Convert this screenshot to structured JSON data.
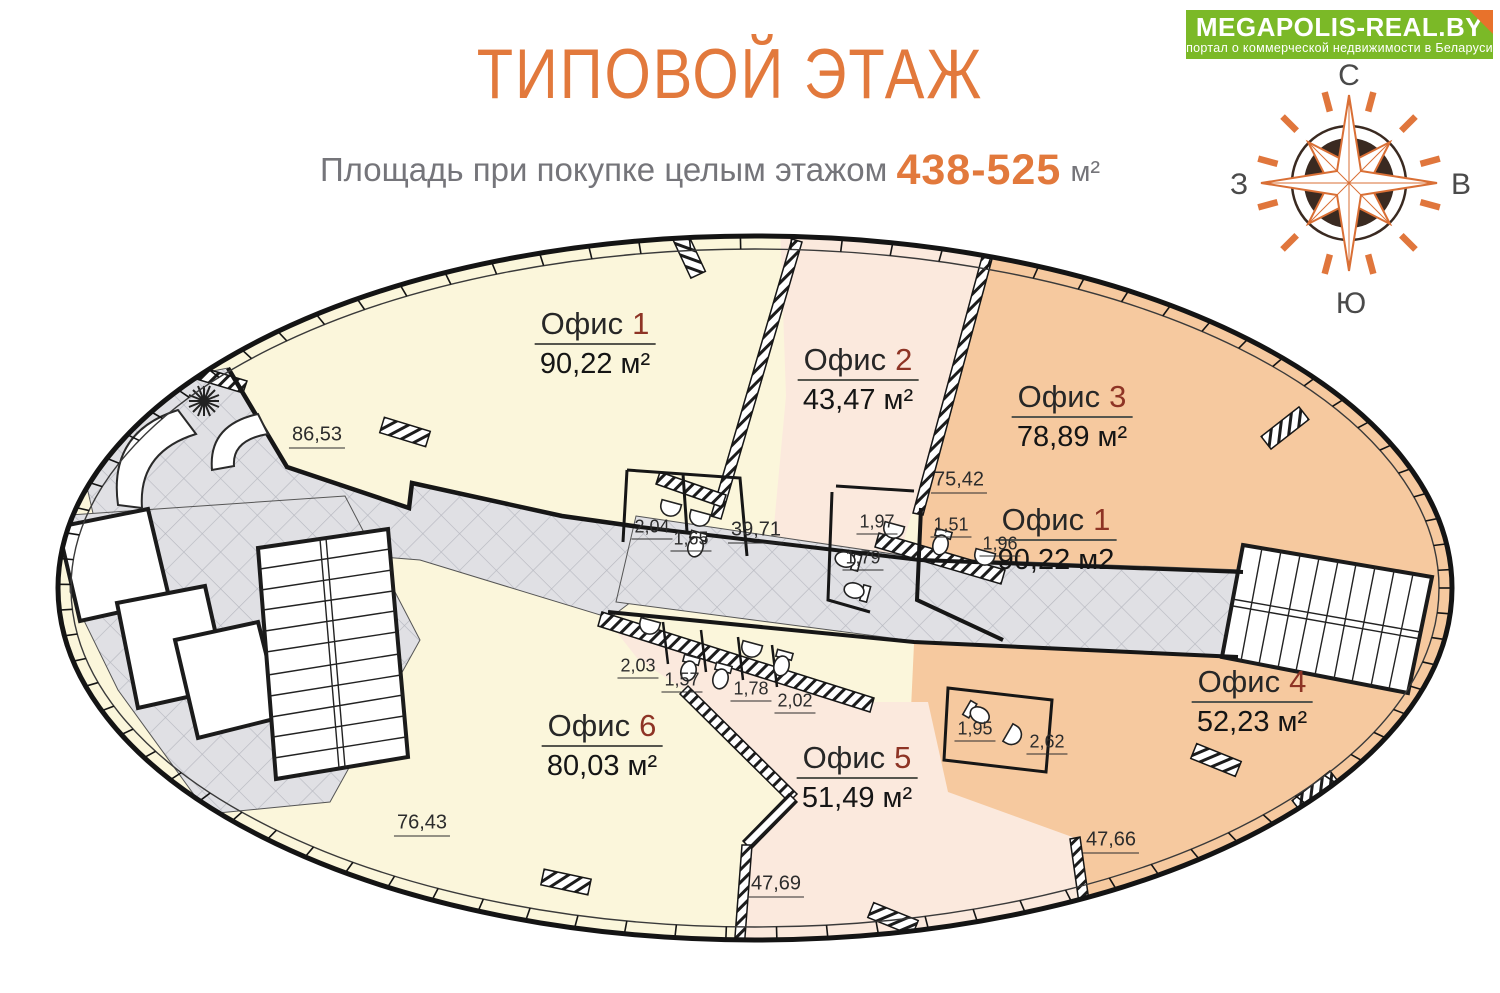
{
  "logo": {
    "title": "MEGAPOLIS-REAL.BY",
    "subtitle": "портал о коммерческой недвижимости в Беларуси"
  },
  "header": {
    "title": "ТИПОВОЙ ЭТАЖ",
    "subtitle_prefix": "Площадь при покупке целым этажом",
    "area_range": "438-525",
    "area_unit": "м²"
  },
  "compass": {
    "north": "С",
    "east": "В",
    "south": "Ю",
    "west": "З"
  },
  "plan": {
    "offices": [
      {
        "id": "office-1",
        "label": "Офис",
        "number": "1",
        "area": "90,22 м²"
      },
      {
        "id": "office-2",
        "label": "Офис",
        "number": "2",
        "area": "43,47 м²"
      },
      {
        "id": "office-3",
        "label": "Офис",
        "number": "3",
        "area": "78,89 м²"
      },
      {
        "id": "office-1b",
        "label": "Офис",
        "number": "1",
        "area": "90,22 м2"
      },
      {
        "id": "office-4",
        "label": "Офис",
        "number": "4",
        "area": "52,23 м²"
      },
      {
        "id": "office-5",
        "label": "Офис",
        "number": "5",
        "area": "51,49 м²"
      },
      {
        "id": "office-6",
        "label": "Офис",
        "number": "6",
        "area": "80,03 м²"
      }
    ],
    "dimensions": [
      "86,53",
      "75,42",
      "39,71",
      "2,04",
      "1,65",
      "1,97",
      "1,51",
      "1,96",
      "1,79",
      "2,03",
      "1,57",
      "1,78",
      "2,02",
      "1,95",
      "2,62",
      "76,43",
      "47,69",
      "47,66"
    ]
  },
  "colors": {
    "accent_orange": "#E2793C",
    "office_number_red": "#8E3425",
    "logo_green": "#7BB927",
    "fold_orange": "#E8722B",
    "fill_yellow": "#FBF6DB",
    "fill_pink": "#FBE9DD",
    "fill_orange": "#F6C99F",
    "corridor_gray": "#E0E0E4"
  }
}
